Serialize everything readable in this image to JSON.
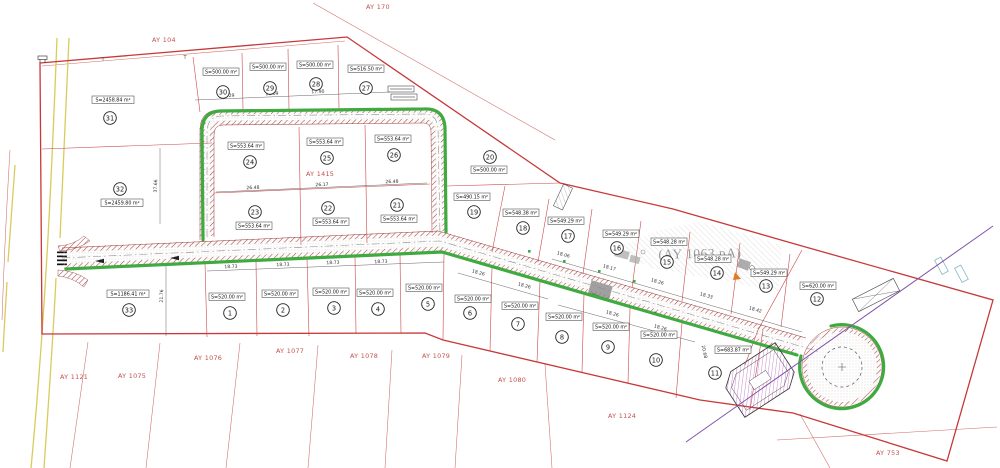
{
  "map": {
    "region_labels": {
      "ay104": "AY 104",
      "ay170": "AY 170",
      "ay1415": "AY 1415",
      "ay1063": "(AY 1063 pA)",
      "ay1121": "AY 1121",
      "ay1075": "AY 1075",
      "ay1076": "AY 1076",
      "ay1077": "AY 1077",
      "ay1078": "AY 1078",
      "ay1079": "AY 1079",
      "ay1080": "AY 1080",
      "ay1124": "AY 1124",
      "ay753": "AY 753"
    },
    "parcels": [
      {
        "num": "1",
        "area": "S=520.00 m²"
      },
      {
        "num": "2",
        "area": "S=520.00 m²"
      },
      {
        "num": "3",
        "area": "S=520.00 m²"
      },
      {
        "num": "4",
        "area": "S=520.00 m²"
      },
      {
        "num": "5",
        "area": "S=520.00 m²"
      },
      {
        "num": "6",
        "area": "S=520.00 m²"
      },
      {
        "num": "7",
        "area": "S=520.00 m²"
      },
      {
        "num": "8",
        "area": "S=520.00 m²"
      },
      {
        "num": "9",
        "area": "S=520.00 m²"
      },
      {
        "num": "10",
        "area": "S=520.00 m²"
      },
      {
        "num": "11",
        "area": "S=683.87 m²"
      },
      {
        "num": "12",
        "area": "S=620.00 m²"
      },
      {
        "num": "13",
        "area": "S=549.29 m²"
      },
      {
        "num": "14",
        "area": "S=548.28 m²"
      },
      {
        "num": "15",
        "area": "S=548.28 m²"
      },
      {
        "num": "16",
        "area": "S=549.29 m²"
      },
      {
        "num": "17",
        "area": "S=549.29 m²"
      },
      {
        "num": "18",
        "area": "S=548.38 m²"
      },
      {
        "num": "19",
        "area": "S=490.15 m²"
      },
      {
        "num": "20",
        "area": "S=500.00 m²"
      },
      {
        "num": "21",
        "area": "S=553.64 m²"
      },
      {
        "num": "22",
        "area": "S=553.64 m²"
      },
      {
        "num": "23",
        "area": "S=553.64 m²"
      },
      {
        "num": "24",
        "area": "S=553.64 m²"
      },
      {
        "num": "25",
        "area": "S=553.64 m²"
      },
      {
        "num": "26",
        "area": "S=553.64 m²"
      },
      {
        "num": "27",
        "area": "S=516.50 m²"
      },
      {
        "num": "28",
        "area": "S=500.00 m²"
      },
      {
        "num": "29",
        "area": "S=500.00 m²"
      },
      {
        "num": "30",
        "area": "S=500.00 m²"
      },
      {
        "num": "31",
        "area": "S=2458.84 m²"
      },
      {
        "num": "32",
        "area": "S=2459.80 m²"
      },
      {
        "num": "33",
        "area": "S=1186.41 m²"
      }
    ],
    "dimensions": [
      "18.29",
      "18.09",
      "17.90",
      "17.94",
      "26.48",
      "26.17",
      "26.48",
      "18.73",
      "18.73",
      "18.73",
      "18.73",
      "18.26",
      "18.26",
      "18.26",
      "18.26",
      "18.06",
      "18.17",
      "18.26",
      "18.33",
      "18.42",
      "20.68",
      "37.66",
      "21.76"
    ],
    "marks": {
      "t1": "T",
      "t2": "T"
    },
    "colors": {
      "boundary": "#c83838",
      "green": "#3faa3f",
      "label_red": "#c0504d",
      "purple": "#8050a8",
      "yellow": "#d8cc5a"
    }
  }
}
